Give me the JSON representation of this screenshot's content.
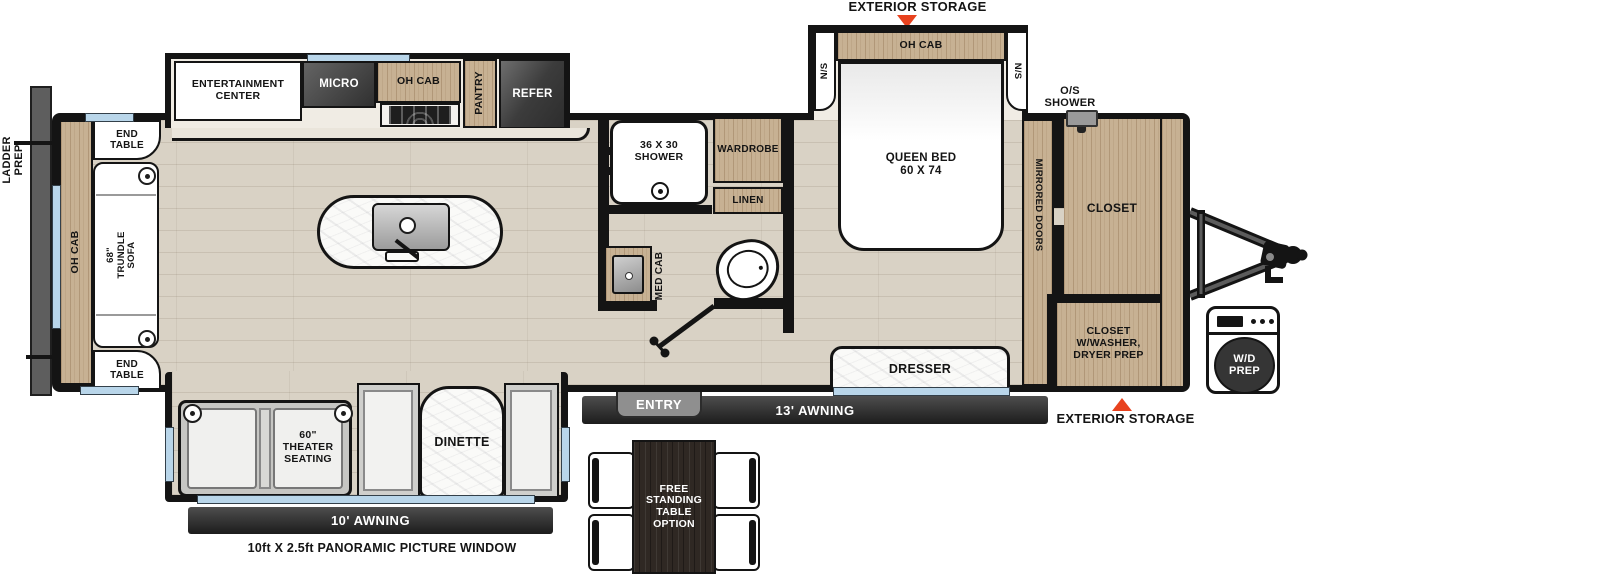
{
  "colors": {
    "accent_red": "#e8421e",
    "wood": "#c7b193",
    "window_blue": "#b9d6ea",
    "appliance_dark": "#3c3c3c",
    "floor": "#d9d2c5",
    "awning_dark": "#1c1c1c"
  },
  "exterior": {
    "storage_top": "EXTERIOR STORAGE",
    "storage_front": "EXTERIOR STORAGE",
    "ladder_prep": "LADDER\nPREP",
    "awning_main": "13' AWNING",
    "awning_rear": "10' AWNING",
    "entry": "ENTRY",
    "panoramic_window": "10ft X 2.5ft PANORAMIC PICTURE WINDOW",
    "os_shower": "O/S\nSHOWER",
    "wd_prep": "W/D\nPREP"
  },
  "kitchen": {
    "entertainment": "ENTERTAINMENT\nCENTER",
    "micro": "MICRO",
    "oh_cab": "OH CAB",
    "pantry": "PANTRY",
    "refer": "REFER"
  },
  "living": {
    "oh_cab": "OH CAB",
    "end_table_top": "END\nTABLE",
    "end_table_bottom": "END\nTABLE",
    "trundle_sofa": "68\"\nTRUNDLE\nSOFA",
    "theater_seating": "60\"\nTHEATER\nSEATING",
    "dinette": "DINETTE",
    "free_table": "FREE\nSTANDING\nTABLE\nOPTION"
  },
  "bath": {
    "shower": "36 X 30\nSHOWER",
    "wardrobe": "WARDROBE",
    "linen": "LINEN",
    "med_cab": "MED CAB"
  },
  "bedroom": {
    "queen_bed": "QUEEN BED\n60 X 74",
    "oh_cab": "OH CAB",
    "ns_left": "N/S",
    "ns_right": "N/S",
    "mirrored_doors": "MIRRORED DOORS",
    "closet": "CLOSET",
    "closet_washer": "CLOSET\nW/WASHER,\nDRYER PREP",
    "dresser": "DRESSER"
  }
}
